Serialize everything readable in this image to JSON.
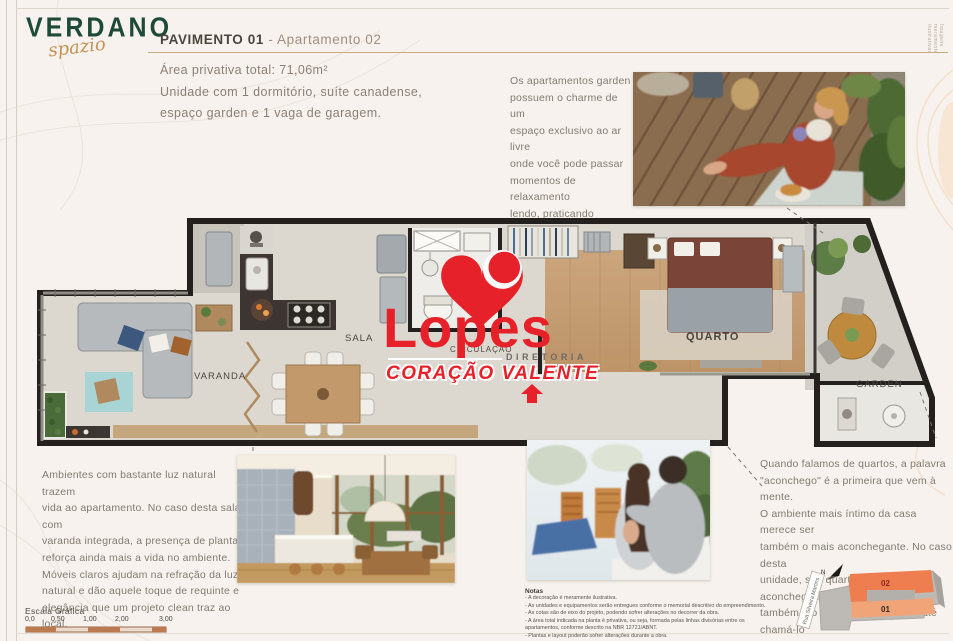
{
  "page": {
    "side_note": "Imagens meramente ilustrativas"
  },
  "logo": {
    "name": "VERDANO",
    "script": "spazio",
    "color_green": "#1e4a3a",
    "color_gold": "#c59157"
  },
  "header": {
    "title_bold": "PAVIMENTO 01",
    "title_sep": " - ",
    "title_light": "Apartamento 02",
    "area": "Área privativa total: 71,06m²",
    "description": "Unidade com 1 dormitório, suíte canadense,\nespaço garden e 1 vaga de garagem."
  },
  "intro": {
    "text": "Os apartamentos garden\npossuem o charme de um\nespaço exclusivo ao ar livre\nonde você pode passar\nmomentos de relaxamento\nlendo, praticando\nyoga, ouvindo música,\ncultivando suas plantas ou\nsimplesmente fazendo nada."
  },
  "plan": {
    "labels": {
      "sala": "SALA",
      "varanda": "VARANDA",
      "circulacao": "CIRCULAÇÃO",
      "quarto": "QUARTO",
      "garden": "GARDEN"
    }
  },
  "watermark": {
    "brand": "Lopes",
    "division": "DIRETORIA",
    "tagline": "CORAÇÃO VALENTE",
    "color": "#e62129"
  },
  "living_text": {
    "text": "Ambientes com bastante luz natural trazem\nvida ao apartamento. No caso desta sala com\nvaranda integrada, a presença de plantas\nreforça ainda mais a vida no ambiente.\nMóveis claros ajudam na refração da luz\nnatural e dão aquele toque de requinte e\nelegância que um projeto clean traz ao local."
  },
  "bedroom_text": {
    "text": "Quando falamos de quartos, a palavra\n\"aconchego\" é a primeira que vem à mente.\nO ambiente mais íntimo da casa merece ser\ntambém o mais aconchegante. No caso desta\nunidade, seu quarto além de aconchegante\ntambém é o mais cool. Podemos até chamá-lo\nde Quarto Garden. Que tal?"
  },
  "notes": {
    "title": "Notas",
    "lines": [
      "- A decoração é meramente ilustrativa.",
      "- As unidades e equipamentos serão entregues conforme o memorial descritivo do empreendimento.",
      "- As cotas são de eixo do projeto, podendo sofrer alterações no decorrer da obra.",
      "- A área total indicada na planta é privativa, ou seja, formada pelas linhas divisórias entre os",
      "apartamentos, conforme descrito na NBR 12721/ABNT.",
      "- Plantas e layout poderão sofrer alterações durante a obra."
    ]
  },
  "scale": {
    "title": "Escala Gráfica",
    "ticks": [
      "0,0",
      "0,50",
      "1,00",
      "2,00",
      "3,00"
    ],
    "bar_color": "#bc7a50"
  },
  "keyplan": {
    "north": "N",
    "street": "Rua Silveira Martins",
    "unit_top": "02",
    "unit_bottom": "01",
    "color_top": "#ee7e50",
    "color_bottom": "#f0a478"
  }
}
